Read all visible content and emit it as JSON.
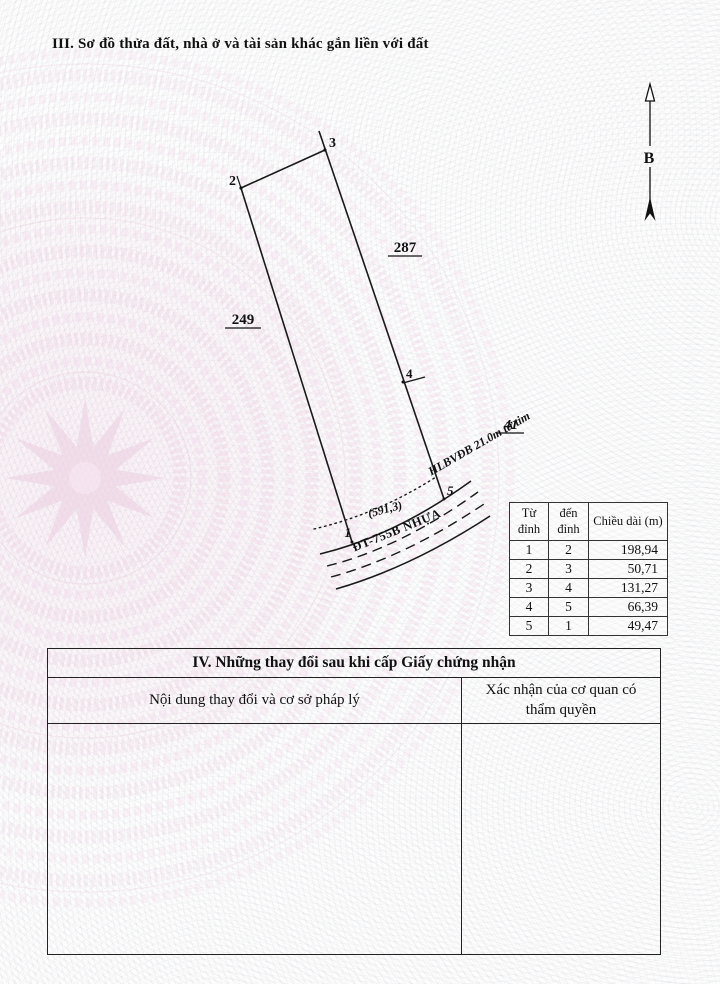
{
  "section3": {
    "title": "III. Sơ đồ thửa đất, nhà ở và tài sản khác gắn liền với đất"
  },
  "compass": {
    "label": "B"
  },
  "diagram": {
    "vertices": [
      "1",
      "2",
      "3",
      "4",
      "5"
    ],
    "parcel_left": "249",
    "parcel_right": "287",
    "parcel_bottom": "41",
    "area": "(591,3)",
    "road": "ĐT-755B NHỰA",
    "corridor": "HLBVĐB 21.0m từ tim"
  },
  "segments": {
    "col_from": "Từ đỉnh",
    "col_to": "đến đỉnh",
    "col_len": "Chiều dài (m)",
    "rows": [
      {
        "from": "1",
        "to": "2",
        "len": "198,94"
      },
      {
        "from": "2",
        "to": "3",
        "len": "50,71"
      },
      {
        "from": "3",
        "to": "4",
        "len": "131,27"
      },
      {
        "from": "4",
        "to": "5",
        "len": "66,39"
      },
      {
        "from": "5",
        "to": "1",
        "len": "49,47"
      }
    ]
  },
  "section4": {
    "title": "IV. Những thay đổi sau khi cấp Giấy chứng nhận",
    "col_content": "Nội dung thay đổi và cơ sở pháp lý",
    "col_confirm": "Xác nhận của cơ quan có thẩm quyền"
  }
}
